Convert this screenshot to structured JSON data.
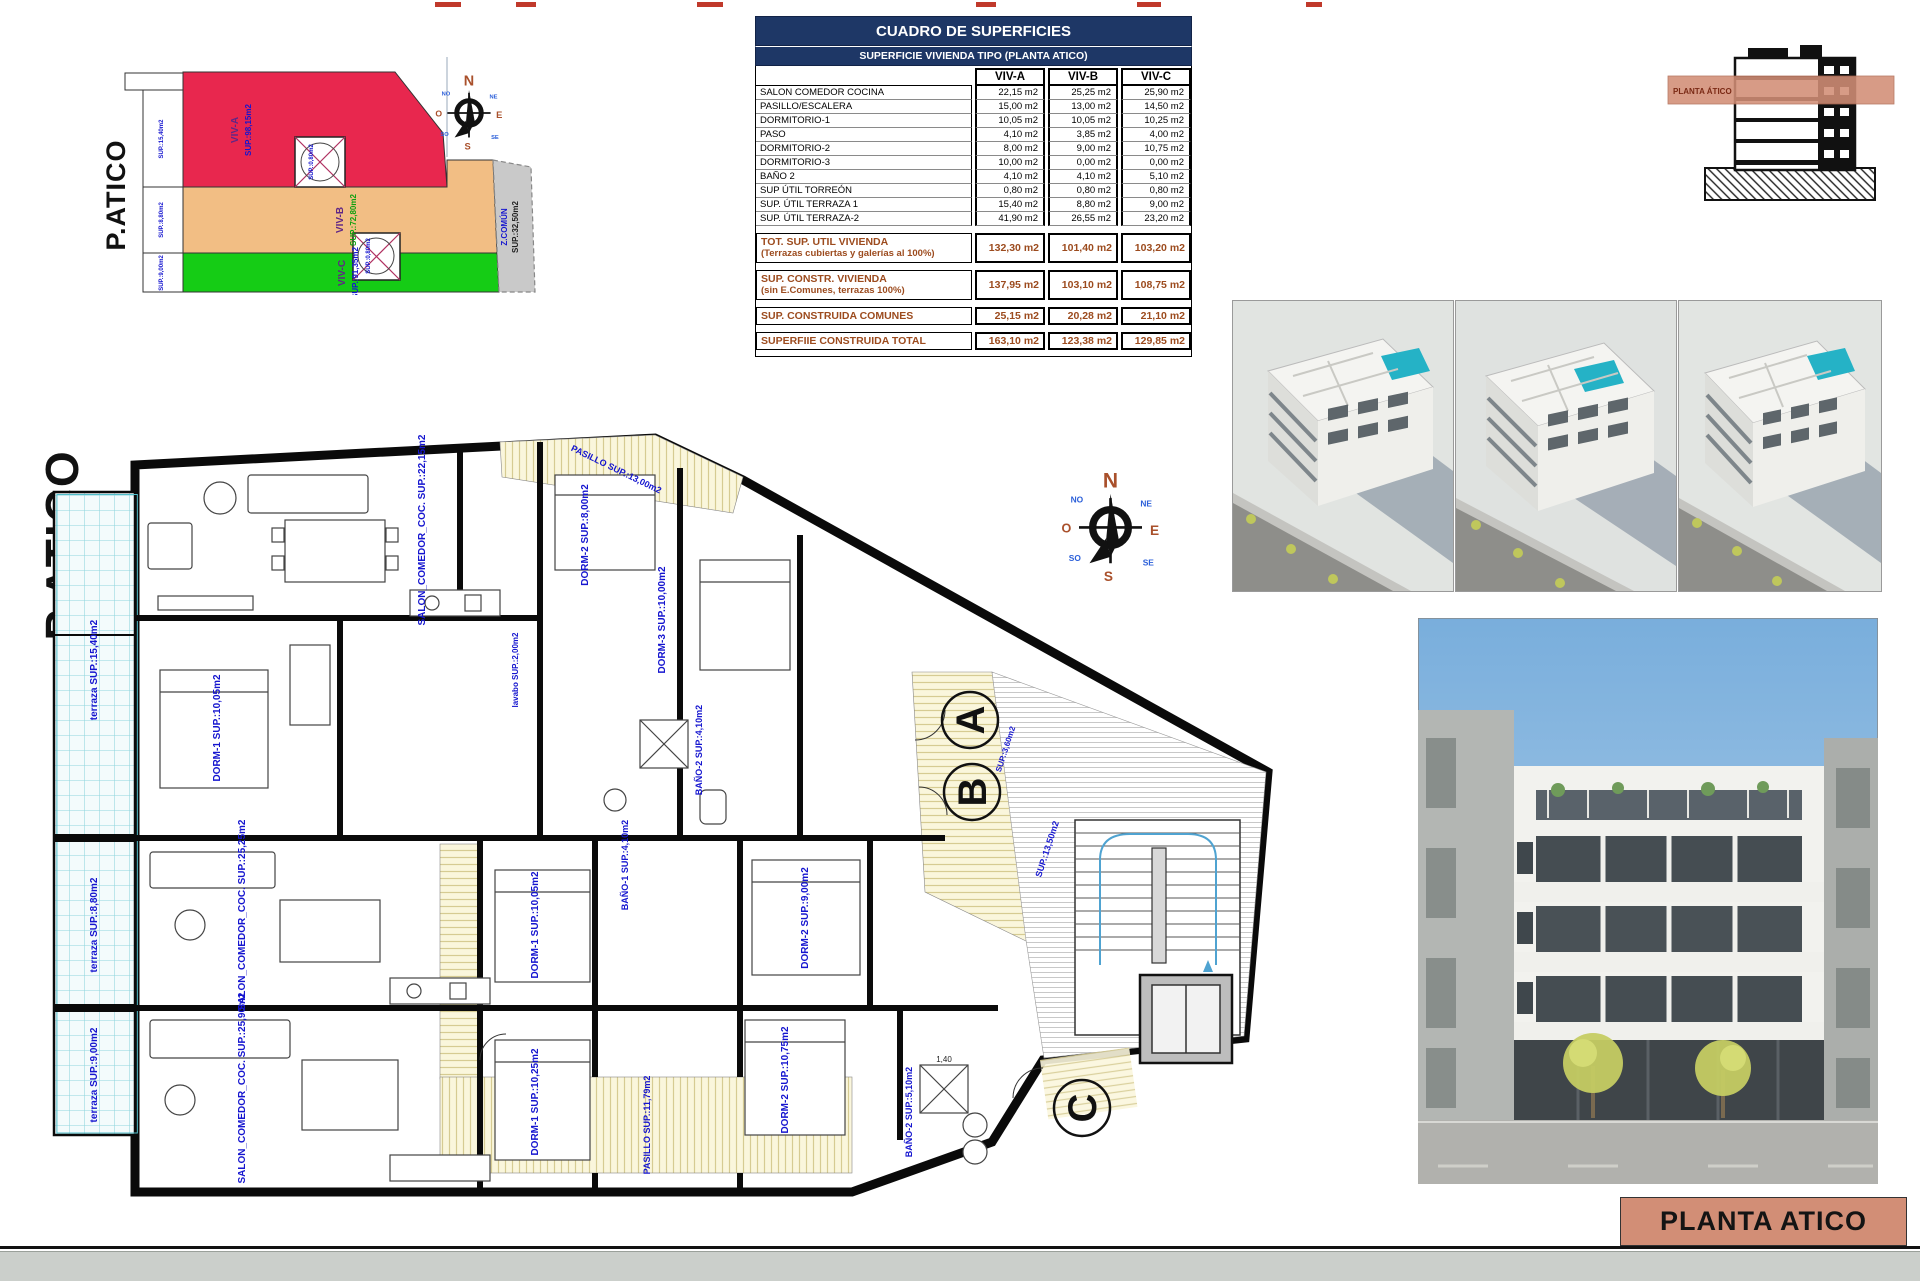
{
  "key_plan": {
    "title": "P.ATICO",
    "zone_a_name": "VIV-A",
    "zone_a_area": "SUP.:98,15m2",
    "zone_b_name": "VIV-B",
    "zone_b_area": "SUP.:72,80m2",
    "zone_c_name": "VIV-C",
    "zone_c_area": "SUP.:91,35m2",
    "zone_common_name": "Z.COMÚN",
    "zone_common_area": "SUP.:32,50m2",
    "edge_area_1": "SUP.:15,40m2",
    "edge_area_2": "SUP.:8,80m2",
    "edge_area_3": "SUP.:9,00m2",
    "torreon_area_1": "SUP.:0,80m2",
    "torreon_area_2": "SUP.:0,80m2",
    "colors": {
      "viv_a": "#E8274E",
      "viv_b": "#F2BE84",
      "viv_c": "#15CC15",
      "comun": "#C9C9C9"
    }
  },
  "compass": {
    "n": "N",
    "s": "S",
    "e": "E",
    "o": "O",
    "ne": "NE",
    "no": "NO",
    "se": "SE",
    "so": "SO"
  },
  "areas_table": {
    "title": "CUADRO DE SUPERFICIES",
    "subtitle": "SUPERFICIE VIVIENDA TIPO  (PLANTA ATICO)",
    "col_a": "VIV-A",
    "col_b": "VIV-B",
    "col_c": "VIV-C",
    "rows": [
      {
        "label": "SALON COMEDOR COCINA",
        "a": "22,15 m2",
        "b": "25,25 m2",
        "c": "25,90 m2"
      },
      {
        "label": "PASILLO/ESCALERA",
        "a": "15,00 m2",
        "b": "13,00 m2",
        "c": "14,50 m2"
      },
      {
        "label": "DORMITORIO-1",
        "a": "10,05 m2",
        "b": "10,05 m2",
        "c": "10,25 m2"
      },
      {
        "label": "PASO",
        "a": "4,10 m2",
        "b": "3,85 m2",
        "c": "4,00 m2"
      },
      {
        "label": "DORMITORIO-2",
        "a": "8,00 m2",
        "b": "9,00 m2",
        "c": "10,75 m2"
      },
      {
        "label": "DORMITORIO-3",
        "a": "10,00 m2",
        "b": "0,00 m2",
        "c": "0,00 m2"
      },
      {
        "label": "BAÑO 2",
        "a": "4,10 m2",
        "b": "4,10 m2",
        "c": "5,10 m2"
      },
      {
        "label": "SUP ÚTIL TORREÓN",
        "a": "0,80 m2",
        "b": "0,80 m2",
        "c": "0,80 m2"
      },
      {
        "label": "SUP. ÚTIL TERRAZA 1",
        "a": "15,40 m2",
        "b": "8,80 m2",
        "c": "9,00 m2"
      },
      {
        "label": "SUP. ÚTIL TERRAZA-2",
        "a": "41,90 m2",
        "b": "26,55 m2",
        "c": "23,20 m2"
      }
    ],
    "totals": [
      {
        "label": "TOT. SUP. UTIL VIVIENDA",
        "sublabel": "(Terrazas cubiertas y galerías al 100%)",
        "a": "132,30 m2",
        "b": "101,40 m2",
        "c": "103,20 m2"
      },
      {
        "label": "SUP. CONSTR. VIVIENDA",
        "sublabel": "(sin E.Comunes, terrazas 100%)",
        "a": "137,95 m2",
        "b": "103,10 m2",
        "c": "108,75 m2"
      },
      {
        "label": "SUP. CONSTRUIDA COMUNES",
        "sublabel": "",
        "a": "25,15 m2",
        "b": "20,28 m2",
        "c": "21,10 m2"
      },
      {
        "label": "SUPERFIIE CONSTRUIDA TOTAL",
        "sublabel": "",
        "a": "163,10 m2",
        "b": "123,38 m2",
        "c": "129,85 m2"
      }
    ]
  },
  "section_diagram": {
    "band_label": "PLANTA ÁTICO"
  },
  "floor_plan": {
    "title": "P.ATICO",
    "unit_a": "A",
    "unit_b": "B",
    "unit_c": "C",
    "labels": {
      "terraza_a": "terraza SUP.:15,40m2",
      "terraza_b": "terraza SUP.:8,80m2",
      "terraza_c": "terraza SUP.:9,00m2",
      "salon_a": "SALON_COMEDOR_COC. SUP.:22,15m2",
      "salon_b": "SALON_COMEDOR_COC. SUP.:25,25m2",
      "salon_c": "SALON_COMEDOR_COC. SUP.:25,90m2",
      "pasillo_top": "PASILLO SUP.:13,00m2",
      "pasillo_bottom": "PASILLO SUP.:11,79m2",
      "dorm1_a": "DORM-1 SUP.:10,05m2",
      "dorm2_a": "DORM-2 SUP.:8,00m2",
      "dorm3_a": "DORM-3 SUP.:10,00m2",
      "bano_a": "BAÑO-2 SUP.:4,10m2",
      "lavabo_a": "lavabo SUP.:2,00m2",
      "dorm1_b": "DORM-1 SUP.:10,05m2",
      "dorm2_b": "DORM-2 SUP.:9,00m2",
      "bano_b": "BAÑO-1 SUP.:4,10m2",
      "dorm1_c": "DORM-1 SUP.:10,25m2",
      "dorm2_c": "DORM-2 SUP.:10,75m2",
      "bano_c": "BAÑO-2 SUP.:5,10m2",
      "comun": "SUP.:13,50m2",
      "hueco": "SUP.:3,60m2",
      "shower_dim": "1,40"
    }
  },
  "title_block": {
    "label": "PLANTA ATICO"
  }
}
